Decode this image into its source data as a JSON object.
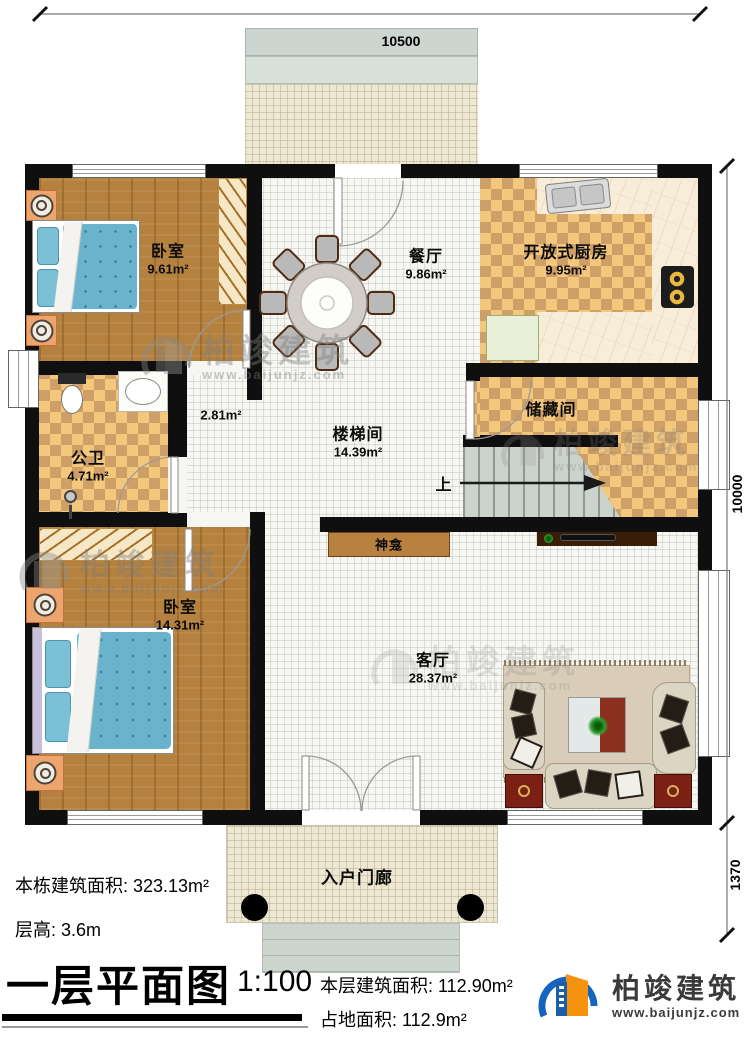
{
  "dimensions": {
    "top": "10500",
    "right_main": "10000",
    "right_porch": "1370"
  },
  "rooms": {
    "bedroom1": {
      "name": "卧室",
      "area": "9.61m²"
    },
    "dining": {
      "name": "餐厅",
      "area": "9.86m²"
    },
    "kitchen": {
      "name": "开放式厨房",
      "area": "9.95m²"
    },
    "hallway": {
      "area": "2.81m²"
    },
    "bathroom": {
      "name": "公卫",
      "area": "4.71m²"
    },
    "stairwell": {
      "name": "楼梯间",
      "area": "14.39m²"
    },
    "storage": {
      "name": "储藏间"
    },
    "shrine": {
      "name": "神龛"
    },
    "bedroom2": {
      "name": "卧室",
      "area": "14.31m²"
    },
    "living": {
      "name": "客厅",
      "area": "28.37m²"
    },
    "entry_porch": {
      "name": "入户门廊"
    }
  },
  "stairs": {
    "up_label": "上"
  },
  "info": {
    "building_total_area": "本栋建筑面积: 323.13m²",
    "floor_height": "层高: 3.6m",
    "title": "一层平面图",
    "scale": "1:100",
    "floor_area": "本层建筑面积: 112.90m²",
    "footprint_area": "占地面积: 112.9m²"
  },
  "brand": {
    "name": "柏竣建筑",
    "url": "www.baijunjz.com"
  },
  "watermark": {
    "name": "柏竣建筑",
    "url": "www.baijunjz.com"
  }
}
